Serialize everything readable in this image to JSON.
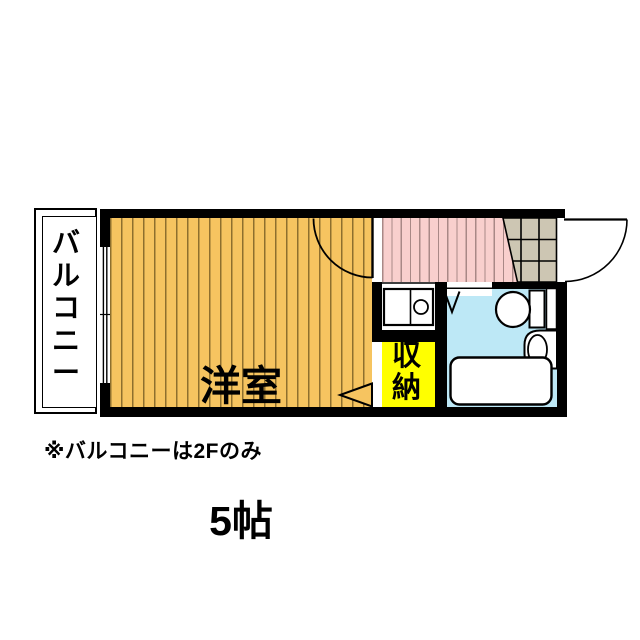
{
  "floorplan": {
    "balcony_label": "バルコニー",
    "room_name": "洋室",
    "room_size": "5帖",
    "storage_label": "収納",
    "note": "※バルコニーは2Fのみ",
    "fixtures": [
      "kitchen-sink",
      "toilet",
      "washbasin",
      "bathtub"
    ],
    "doors": [
      "entrance-door",
      "room-door",
      "bathroom-folding-door",
      "closet-door"
    ]
  },
  "colors": {
    "wall": "#000000",
    "room_floor": "#F6C460",
    "room_stripe": "#8E6F2E",
    "hall_floor": "#F9CFCD",
    "hall_stripe": "#A98886",
    "storage_fill": "#FFFF00",
    "bath_floor": "#BDE8F6",
    "entrance_tile": "#CDC6B3",
    "background": "#FFFFFF"
  }
}
